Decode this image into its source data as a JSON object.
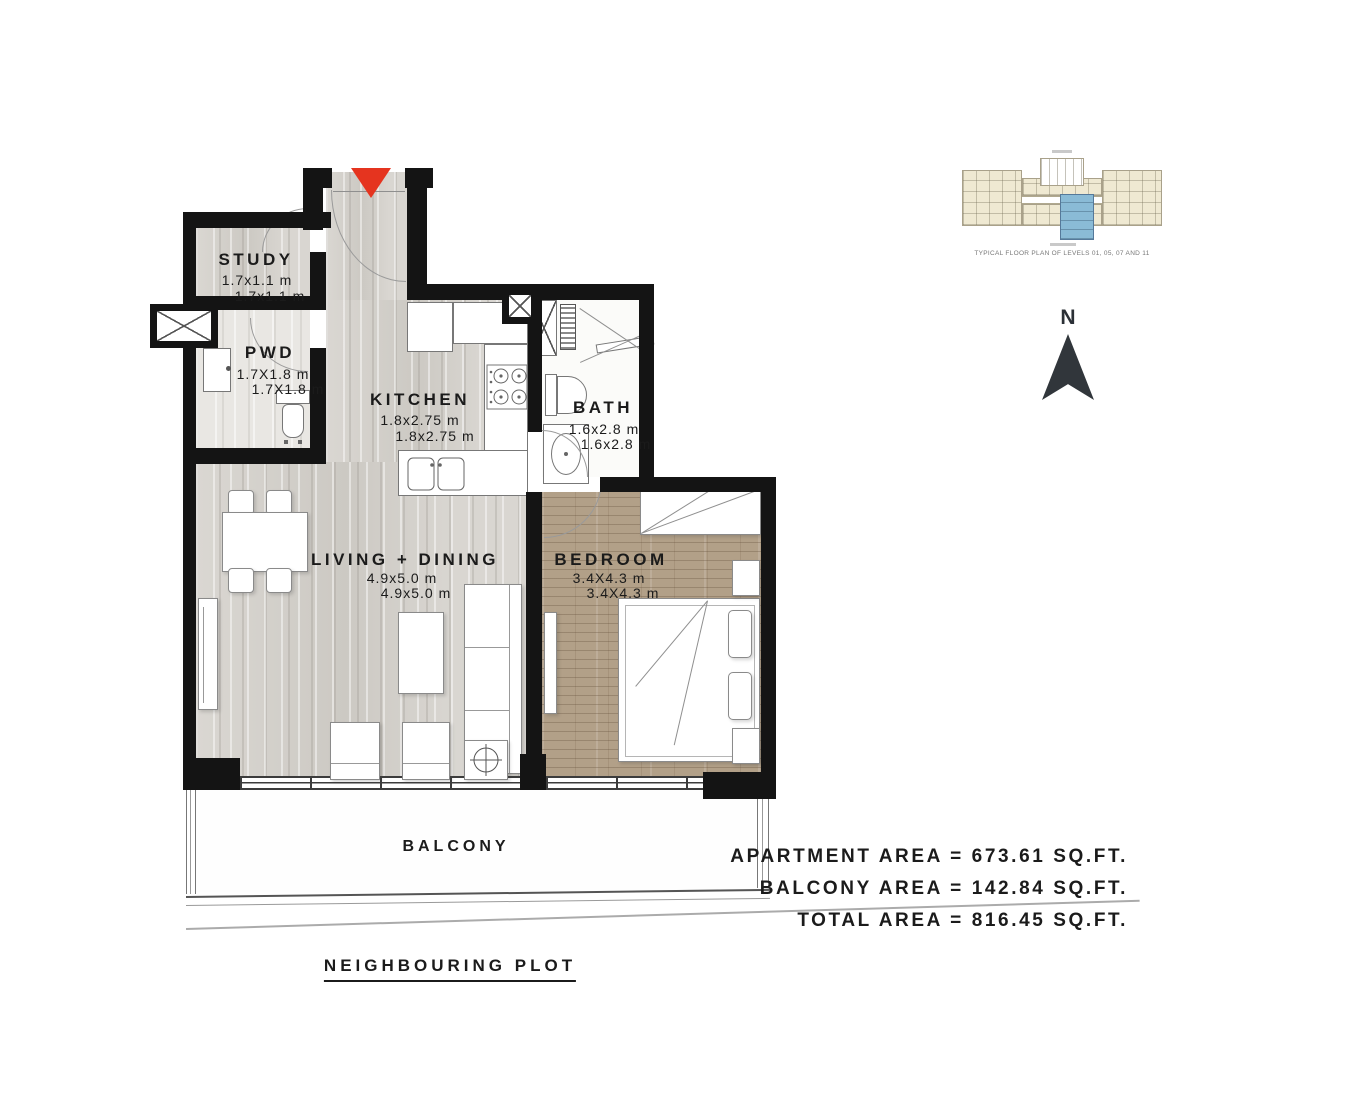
{
  "plan": {
    "rooms": {
      "study": {
        "name": "STUDY",
        "dim1": "1.7x1.1 m",
        "dim2": "1.7x1.1 m"
      },
      "pwd": {
        "name": "PWD",
        "dim1": "1.7X1.8 m",
        "dim2": "1.7X1.8 m"
      },
      "kitchen": {
        "name": "KITCHEN",
        "dim1": "1.8x2.75 m",
        "dim2": "1.8x2.75 m"
      },
      "bath": {
        "name": "BATH",
        "dim1": "1.6x2.8 m",
        "dim2": "1.6x2.8 m"
      },
      "living": {
        "name": "LIVING + DINING",
        "dim1": "4.9x5.0 m",
        "dim2": "4.9x5.0 m"
      },
      "bedroom": {
        "name": "BEDROOM",
        "dim1": "3.4X4.3 m",
        "dim2": "3.4X4.3 m"
      }
    },
    "balcony_label": "BALCONY",
    "neighbouring_plot_label": "NEIGHBOURING PLOT"
  },
  "areas": {
    "apartment": "APARTMENT AREA = 673.61 SQ.FT.",
    "balcony": "BALCONY AREA = 142.84 SQ.FT.",
    "total": "TOTAL AREA = 816.45 SQ.FT."
  },
  "key_plan": {
    "caption": "TYPICAL FLOOR PLAN OF LEVELS 01, 05, 07 AND 11"
  },
  "compass": {
    "north_label": "N"
  },
  "colors": {
    "wall": "#141414",
    "entry_arrow": "#e5341f",
    "marble_floor": "#d6d3ce",
    "wood_floor": "#b2a088",
    "keyplan_unit": "#efe9d2",
    "keyplan_highlight": "#8abbd6"
  }
}
